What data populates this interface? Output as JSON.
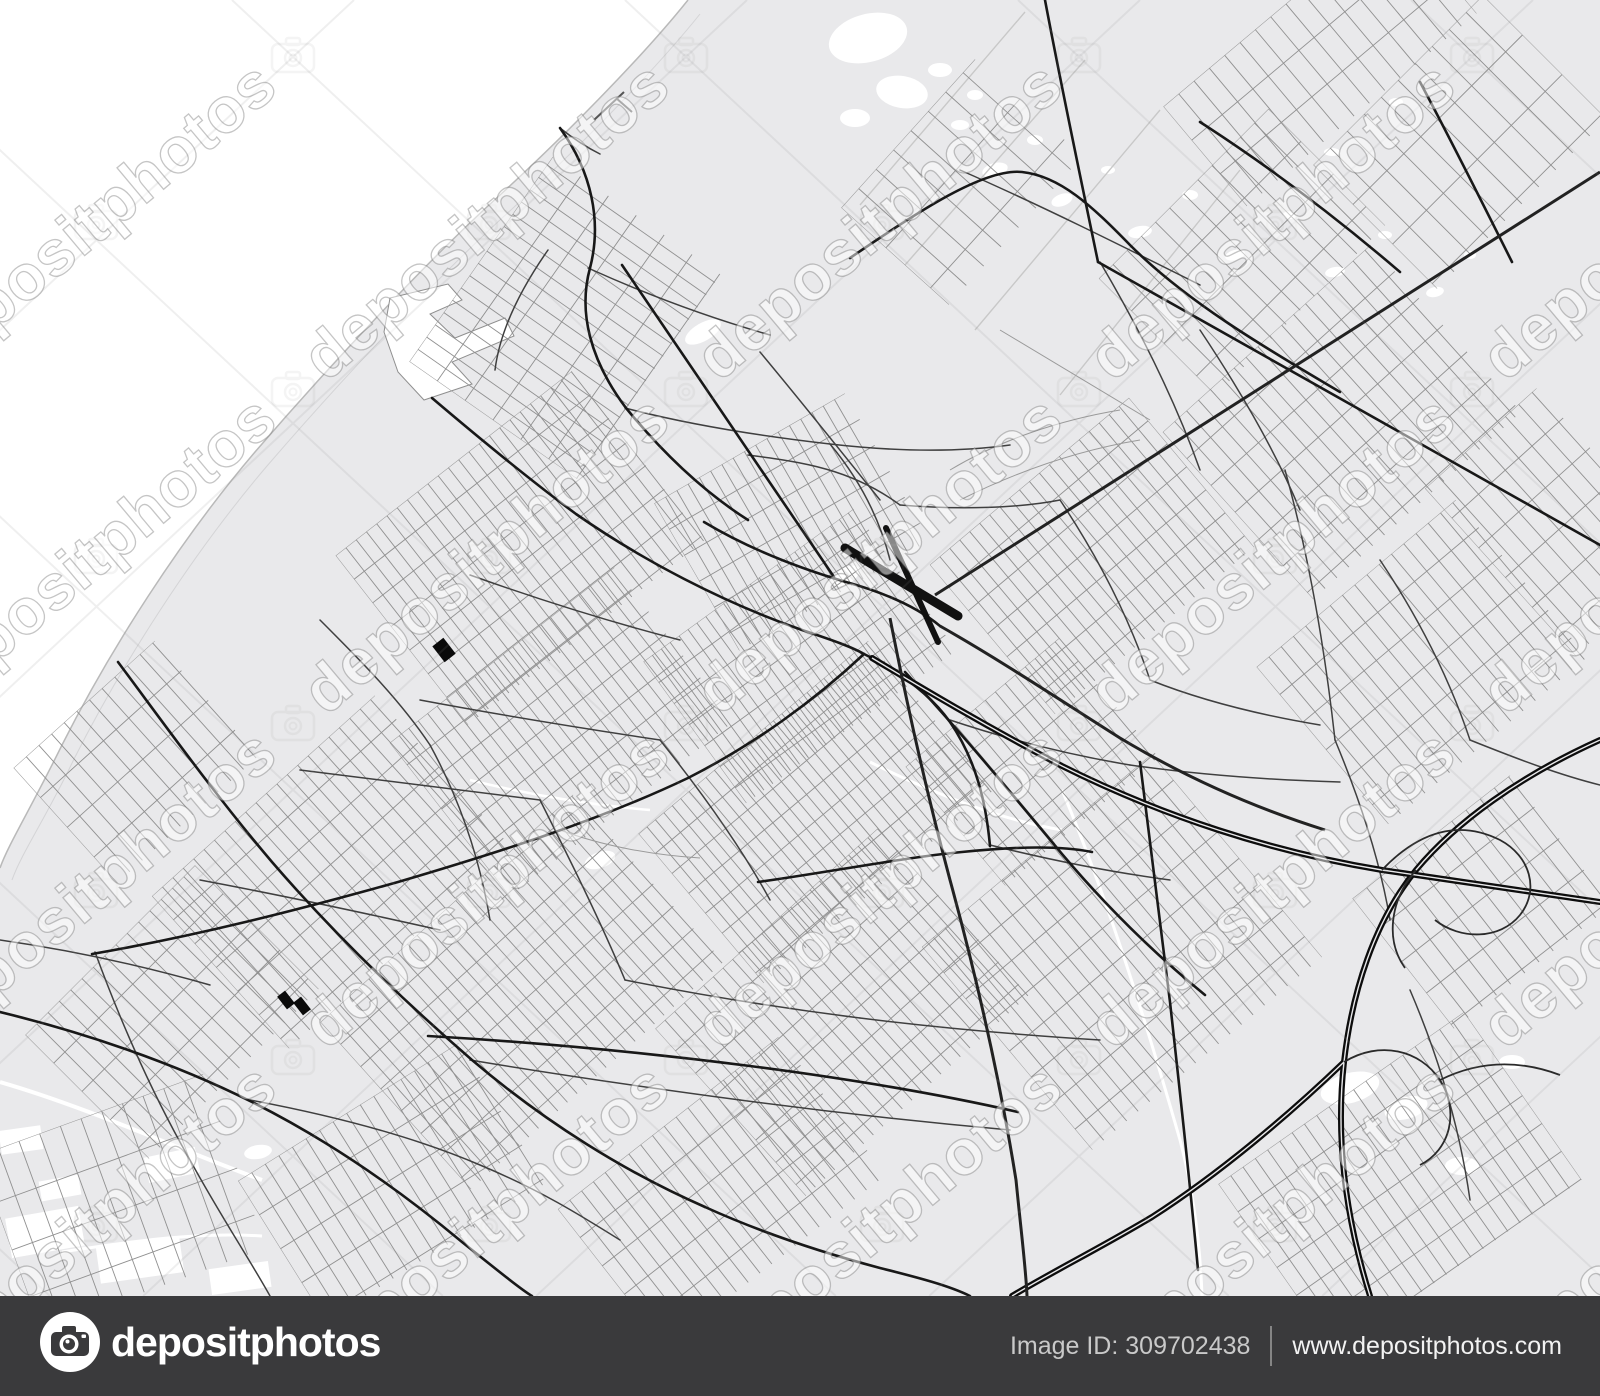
{
  "watermark": {
    "text": "depositphotos"
  },
  "footer": {
    "brand": "depositphotos",
    "image_id_label": "Image ID:",
    "image_id": "309702438",
    "website": "www.depositphotos.com",
    "bar_color": "#3a3a3c"
  },
  "map": {
    "colors": {
      "land": "#e9e9eb",
      "water": "#ffffff",
      "coastline": "#b9b9b9",
      "dune_trail": "#c8c8c8",
      "road_minor": "#909090",
      "road_secondary": "#3f3f3f",
      "road_major": "#181818",
      "motorway": "#0d0d0d",
      "railway": "#222222",
      "park_path": "#9a9a9a",
      "watermark_gray": "#8a8a8a"
    }
  }
}
